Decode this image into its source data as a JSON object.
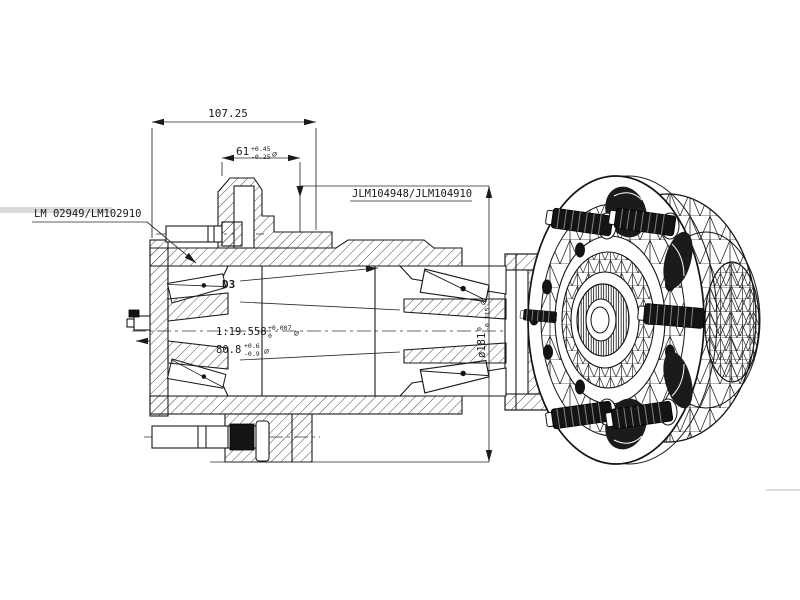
{
  "colors": {
    "background": "#ffffff",
    "line": "#1a1a1a",
    "stud_fill": "#141414",
    "label_stripe": "#d9d9d9"
  },
  "section_view": {
    "labels": {
      "bearing_outboard": "LM 02949/LM102910",
      "bearing_inboard": "JLM104948/JLM104910",
      "detail_marker": "D3"
    },
    "dimensions": {
      "overall_width": {
        "value": "107.25"
      },
      "pilot_width": {
        "value": "61",
        "tol_upper": "+0.45",
        "tol_lower": "-0.25",
        "suffix": "⌀"
      },
      "bore_taper": {
        "value": "1:19.558",
        "tol_upper": "+0.007",
        "tol_lower": "0",
        "suffix": "⌀"
      },
      "hub_width": {
        "value": "80.8",
        "tol_upper": "+0.6",
        "tol_lower": "-0.9",
        "suffix": "⌀"
      },
      "flange_diameter": {
        "value": "ø181",
        "tol_upper": "0",
        "tol_lower": "-0.115",
        "suffix": "⌀"
      }
    }
  }
}
